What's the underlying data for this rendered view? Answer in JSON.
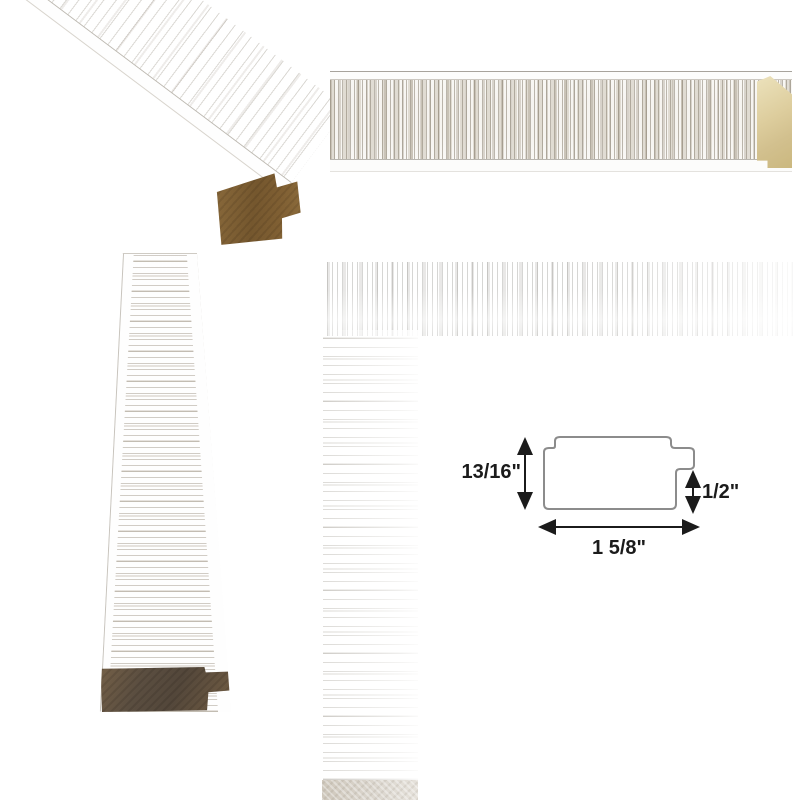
{
  "diagram": {
    "height_label": "13/16\"",
    "rabbet_label": "1/2\"",
    "width_label": "1 5/8\""
  },
  "colors": {
    "background": "#ffffff",
    "diagram_outline": "#8c8c8c",
    "diagram_ink": "#1b1b1b",
    "moulding_face": "#f6f4f0",
    "texture_streak": "#8a8171",
    "wood_end_tan": "#b1996f",
    "wood_end_taupe": "#8f8478",
    "gilt_edge": "#d2c08e"
  }
}
